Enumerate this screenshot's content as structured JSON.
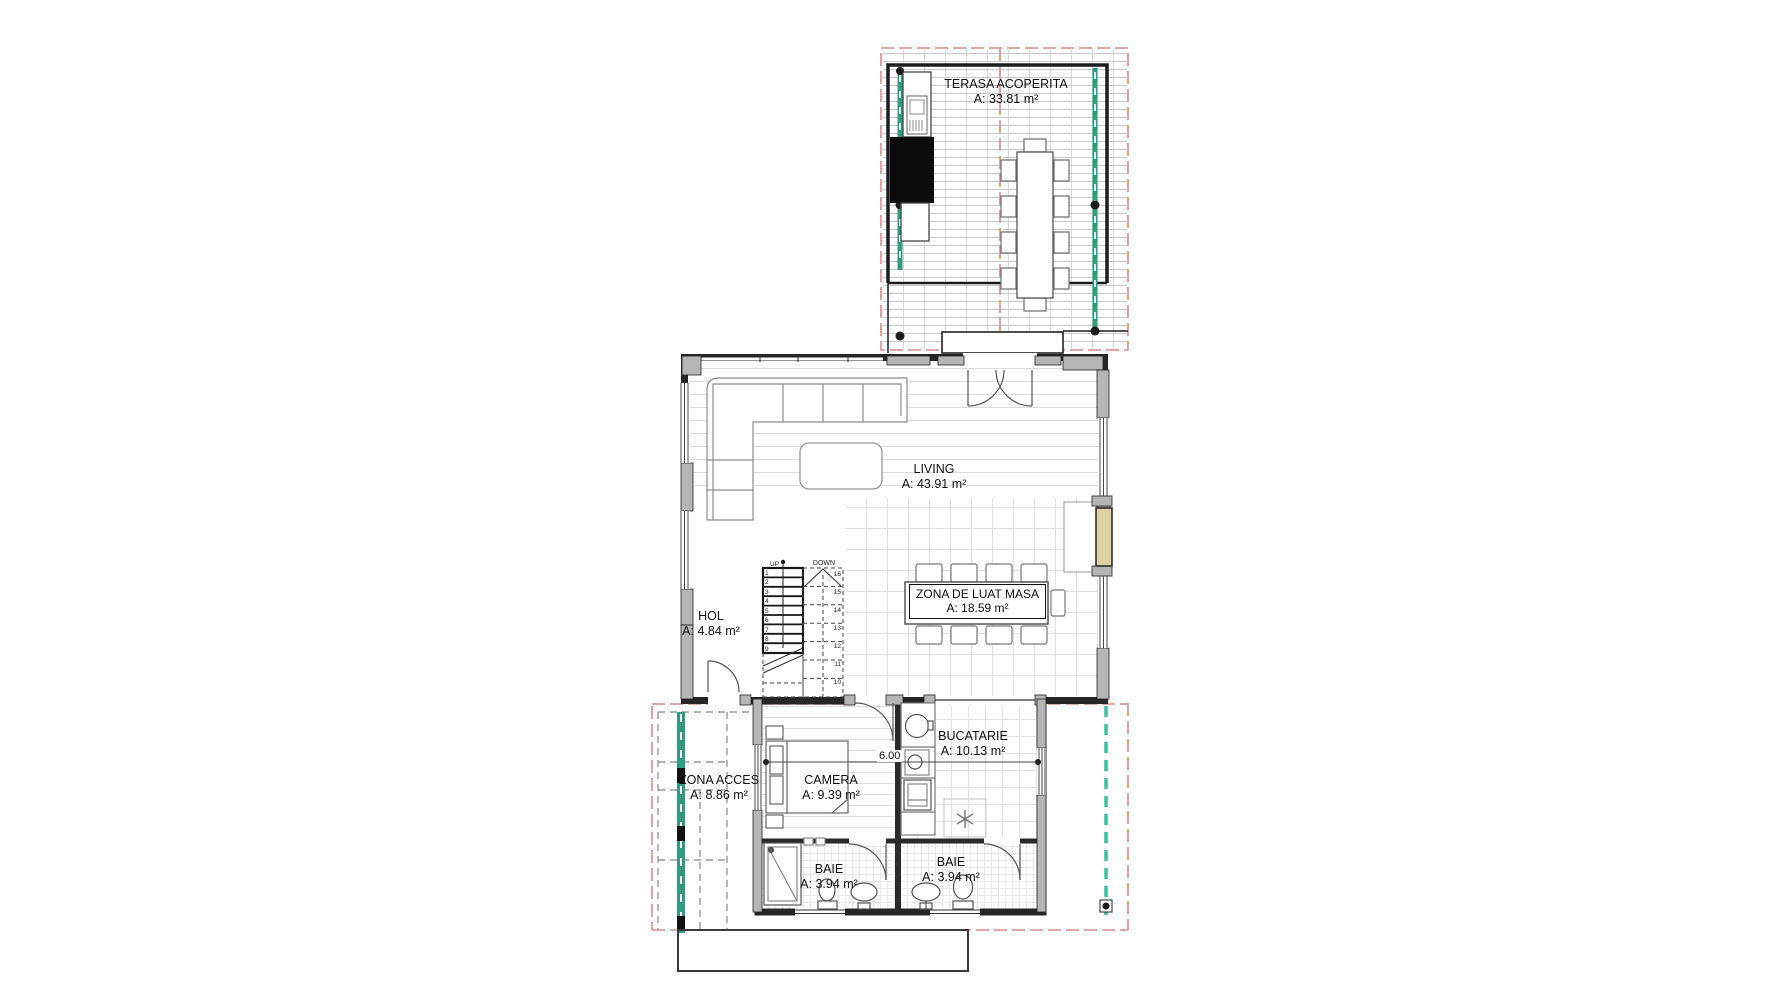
{
  "rooms": {
    "terasa": {
      "name": "TERASA ACOPERITA",
      "area": "A: 33.81 m²"
    },
    "living": {
      "name": "LIVING",
      "area": "A: 43.91 m²"
    },
    "dining": {
      "name": "ZONA DE LUAT MASA",
      "area": "A: 18.59 m²"
    },
    "hol": {
      "name": "HOL",
      "area": "A: 4.84 m²"
    },
    "bucatarie": {
      "name": "BUCATARIE",
      "area": "A: 10.13 m²"
    },
    "camera": {
      "name": "CAMERA",
      "area": "A: 9.39 m²"
    },
    "zona_acces": {
      "name": "ZONA ACCES",
      "area": "A: 8.86 m²"
    },
    "baie_1": {
      "name": "BAIE",
      "area": "A: 3.94 m²"
    },
    "baie_2": {
      "name": "BAIE",
      "area": "A: 3.94 m²"
    }
  },
  "stairs": {
    "up_label": "UP",
    "down_label": "DOWN",
    "left_steps": [
      "1",
      "2",
      "3",
      "4",
      "5",
      "6",
      "7",
      "8",
      "9"
    ],
    "right_steps": [
      "16",
      "15",
      "14",
      "13",
      "12",
      "11",
      "10"
    ]
  },
  "dimensions": {
    "width_6m": "6.00"
  },
  "colors": {
    "wall": "#262626",
    "wall_fill": "#b5b5b5",
    "glass_teal": "#2f9c80",
    "porch_teal": "#3fbf9d",
    "boundary_red": "#d98b8b",
    "fireplace_beige": "#ddd0a4"
  }
}
